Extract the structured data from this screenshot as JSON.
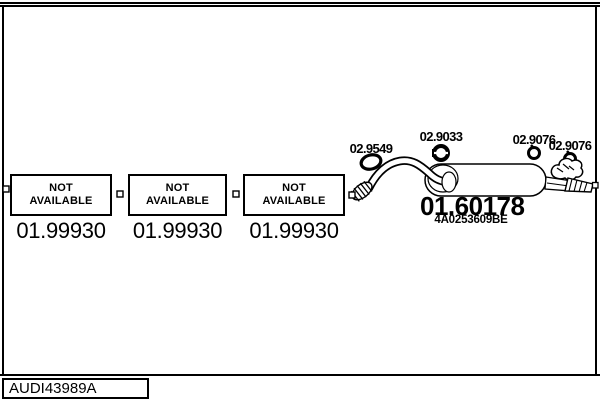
{
  "page": {
    "background": "#ffffff",
    "line_color": "#000000"
  },
  "footer": {
    "code": "AUDI43989A"
  },
  "placeholders": [
    {
      "label": "NOT AVAILABLE",
      "part_number": "01.99930"
    },
    {
      "label": "NOT AVAILABLE",
      "part_number": "01.99930"
    },
    {
      "label": "NOT AVAILABLE",
      "part_number": "01.99930"
    }
  ],
  "parts": {
    "gasket": {
      "label": "02.9549"
    },
    "clamp_front": {
      "label": "02.9033"
    },
    "clamp_mid": {
      "label": "02.9076"
    },
    "clamp_rear": {
      "label": "02.9076"
    },
    "rear_muffler": {
      "part_number": "01.60178",
      "oem_reference": "4A0253609BE"
    }
  }
}
